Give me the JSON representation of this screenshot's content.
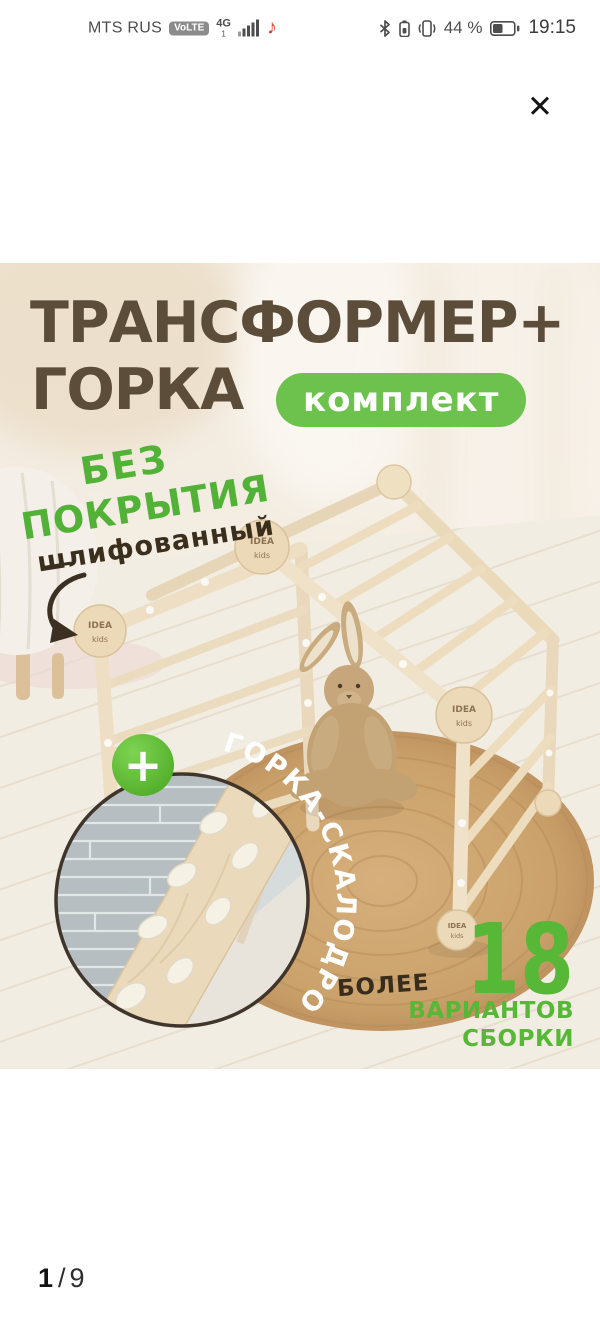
{
  "status_bar": {
    "carrier": "MTS RUS",
    "volte_badge": "VoLTE",
    "network": "4G",
    "sim_slot": "1",
    "battery_percent": "44 %",
    "time": "19:15",
    "music_note_icon": "♪"
  },
  "viewer": {
    "close_icon": "✕",
    "pager": {
      "current": "1",
      "separator": "/",
      "total": "9"
    }
  },
  "product_image": {
    "title_line1": "ТРАНСФОРМЕР+",
    "title_line2": "ГОРКА",
    "kit_badge": "комплект",
    "finish_note_line1": "БЕЗ",
    "finish_note_line2": "ПОКРЫТИЯ",
    "finish_note_line3": "шлифованный",
    "inset_caption": "ГОРКА-СКАЛОДРОМ",
    "plus_icon": "+",
    "variants_prefix": "БОЛЕЕ",
    "variants_count": "18",
    "variants_word1": "ВАРИАНТОВ",
    "variants_word2": "СБОРКИ",
    "brand_disc_line1": "IDEA",
    "brand_disc_line2": "kids"
  },
  "colors": {
    "accent_green": "#57b737",
    "badge_green": "#6cc24c",
    "title_brown": "#5c4c3a"
  }
}
